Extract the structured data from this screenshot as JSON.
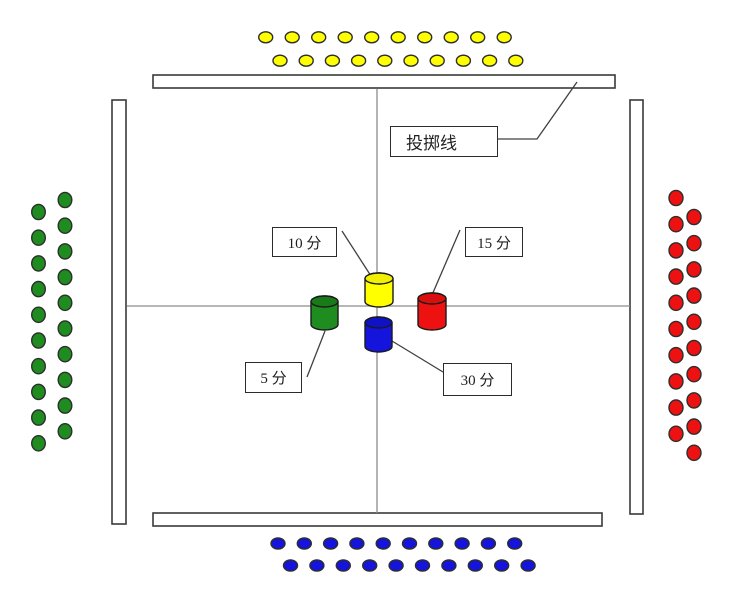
{
  "page": {
    "background": "#ffffff"
  },
  "labels": {
    "throw_line": "投掷线",
    "score_10": "10 分",
    "score_15": "15 分",
    "score_5": "5 分",
    "score_30": "30 分"
  },
  "colors": {
    "yellow": "#ffff00",
    "green": "#1e8c1e",
    "red": "#ee1111",
    "blue": "#1414dd",
    "cylinder_outline": "#1a1a1a",
    "chip_outline": "#2e2e2e",
    "wall_fill": "#ffffff",
    "wall_border": "#3a3a3a",
    "center_line": "#8c8c8c",
    "callout_line": "#404040"
  },
  "cylinders": [
    {
      "name": "yellow-cylinder",
      "score_label": "10 分",
      "color": "#ffff00",
      "top_color": "#f2ef04",
      "x": 365,
      "y": 273,
      "w": 28,
      "h": 34,
      "e": 5.5
    },
    {
      "name": "green-cylinder",
      "score_label": "5 分",
      "color": "#1e8c1e",
      "top_color": "#187a18",
      "x": 311,
      "y": 296,
      "w": 27,
      "h": 34,
      "e": 5.5
    },
    {
      "name": "red-cylinder",
      "score_label": "15 分",
      "color": "#ee1111",
      "top_color": "#d90e0e",
      "x": 418,
      "y": 293,
      "w": 28,
      "h": 37,
      "e": 5.5
    },
    {
      "name": "blue-cylinder",
      "score_label": "30 分",
      "color": "#1414dd",
      "top_color": "#1010c4",
      "x": 365,
      "y": 317,
      "w": 27,
      "h": 35,
      "e": 5.5
    }
  ],
  "chip_groups": [
    {
      "name": "yellow-chips-top",
      "color": "#ffff00",
      "rx": 7,
      "ry": 5.5,
      "lines": [
        {
          "x0": 265.7,
          "y0": 37.3,
          "dx": 26.5,
          "dy": 0,
          "n": 10
        },
        {
          "x0": 280.0,
          "y0": 60.7,
          "dx": 26.2,
          "dy": 0,
          "n": 10
        }
      ]
    },
    {
      "name": "blue-chips-bottom",
      "color": "#1414dd",
      "rx": 7,
      "ry": 5.5,
      "lines": [
        {
          "x0": 278.0,
          "y0": 543.5,
          "dx": 26.3,
          "dy": 0,
          "n": 10
        },
        {
          "x0": 290.5,
          "y0": 565.5,
          "dx": 26.4,
          "dy": 0,
          "n": 10
        }
      ]
    },
    {
      "name": "green-chips-left",
      "color": "#1e8c1e",
      "rx": 6.8,
      "ry": 7.6,
      "lines": [
        {
          "x0": 65.0,
          "y0": 200.0,
          "dx": 0,
          "dy": 25.7,
          "n": 10
        },
        {
          "x0": 38.5,
          "y0": 212.0,
          "dx": 0,
          "dy": 25.7,
          "n": 10
        }
      ]
    },
    {
      "name": "red-chips-right",
      "color": "#ee1111",
      "rx": 7,
      "ry": 7.6,
      "lines": [
        {
          "x0": 676.0,
          "y0": 198.0,
          "dx": 0,
          "dy": 26.2,
          "n": 10
        },
        {
          "x0": 694.0,
          "y0": 217.0,
          "dx": 0,
          "dy": 26.2,
          "n": 10
        }
      ]
    }
  ]
}
